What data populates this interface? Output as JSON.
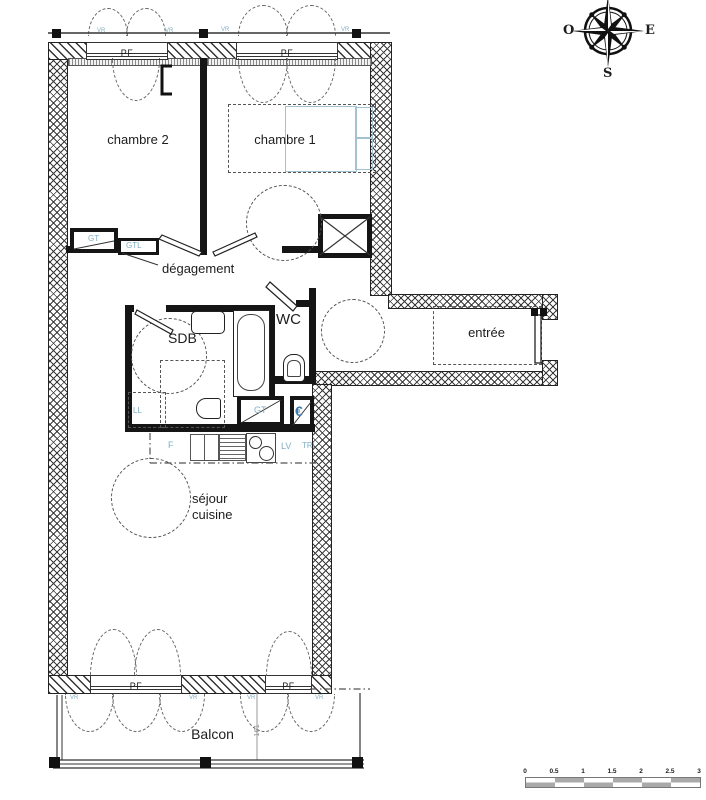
{
  "compass": {
    "west": "O",
    "east": "E",
    "south": "S"
  },
  "rooms": {
    "chambre2": "chambre 2",
    "chambre1": "chambre 1",
    "degagement": "dégagement",
    "sdb": "SDB",
    "wc": "WC",
    "entree": "entrée",
    "sejour_line1": "séjour",
    "sejour_line2": "cuisine",
    "balcon": "Balcon"
  },
  "windows": {
    "pf_label": "PF",
    "vr_label": "VR"
  },
  "equipment": {
    "gt_hall": "GT",
    "gtl": "GTL",
    "ll": "LL",
    "fridge": "F",
    "dishwasher": "LV",
    "tri": "TRI",
    "gt_kitchen": "GT",
    "euro": "€"
  },
  "dimensions": {
    "balcony": "161"
  },
  "scale_bar": {
    "ticks": [
      "0",
      "0.5",
      "1",
      "1.5",
      "2",
      "2.5",
      "3"
    ]
  },
  "colors": {
    "wall_line": "#1a1a1a",
    "equipment_blue": "#7fafc4",
    "euro_blue": "#3f78a6",
    "bed_blue": "#a3c2d1",
    "dimension_gray": "#909090"
  }
}
